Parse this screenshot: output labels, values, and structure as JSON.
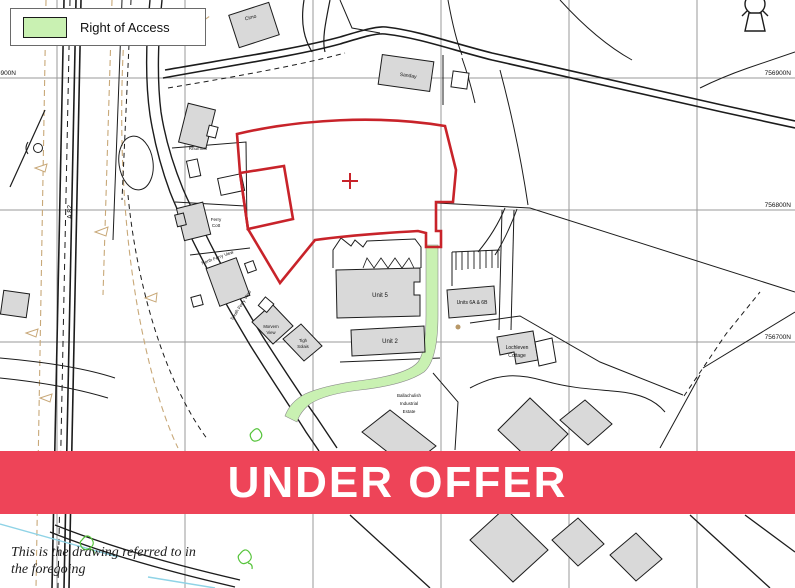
{
  "legend": {
    "label": "Right of Access",
    "swatch_color": "#c9f1b2"
  },
  "banner": {
    "text": "UNDER OFFER",
    "color": "#ee4458",
    "text_color": "#ffffff"
  },
  "map_labels": {
    "cimo": "Cimo",
    "sanday": "Sanday",
    "rhumner": "Rhumner",
    "ferry_cott": {
      "line1": "Ferry",
      "line2": "Cott"
    },
    "north_ferry_view": "North Ferry View",
    "south_ferry_view": "South Ferry View",
    "morvern_view": {
      "line1": "Morvern",
      "line2": "View"
    },
    "tigh_solais": {
      "line1": "Tigh",
      "line2": "Solais"
    },
    "unit5": "Unit 5",
    "unit2": "Unit 2",
    "units6": "Units 6A & 6B",
    "lochleven": {
      "line1": "Lochleven",
      "line2": "Cottage"
    },
    "ballachulish": {
      "line1": "Ballachulish",
      "line2": "Industrial",
      "line3": "Estate"
    },
    "road": "A 82"
  },
  "grid": {
    "northings": [
      "756900N",
      "756800N",
      "756700N"
    ],
    "left_northing": "756900N"
  },
  "footer": {
    "line1": "This is the drawing referred to in",
    "line2": "the foregoing"
  },
  "colors": {
    "boundary_red": "#c8232a",
    "access_green": "#c9f1b2",
    "building_grey": "#d9d9d9",
    "grid_grey": "#9a9a9a",
    "water_cyan": "#8fd3e6",
    "contour_tan": "#c8a878",
    "vegetation_green": "#57c43c"
  }
}
